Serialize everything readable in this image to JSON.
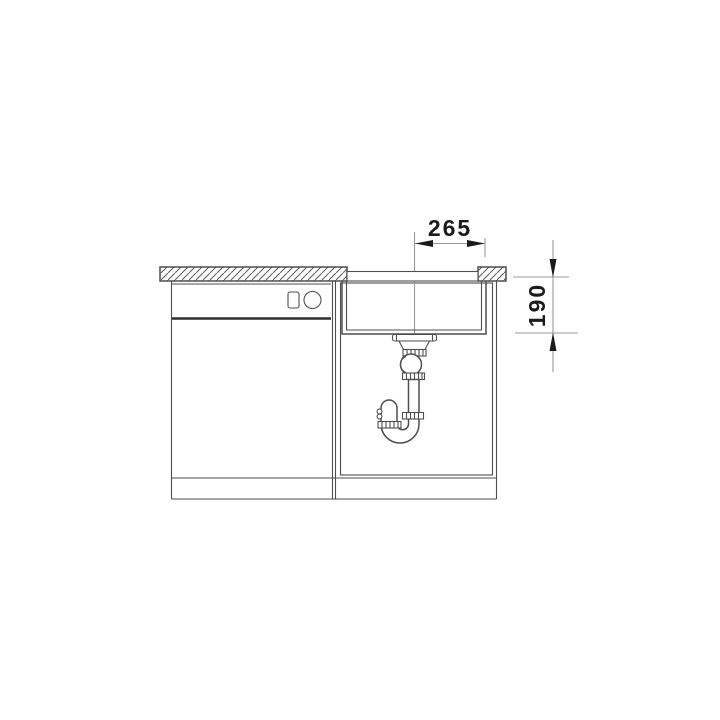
{
  "diagram": {
    "title": "sink-installation-section-drawing",
    "type": "technical line drawing",
    "dimensions": [
      {
        "name": "drain-to-edge-width",
        "value": "265",
        "orientation": "horizontal"
      },
      {
        "name": "bowl-depth",
        "value": "190",
        "orientation": "vertical"
      }
    ],
    "colors": {
      "bg": "#ffffff",
      "line": "#4e4e4e",
      "dim": "#9b9b9b",
      "ink": "#1b1b1b"
    },
    "parts": [
      "countertop-section-hatched",
      "sink-rim",
      "sink-bowl",
      "drain-strainer",
      "siphon-p-trap",
      "adjacent-cabinet",
      "sink-base-cabinet",
      "cabinet-plinth"
    ]
  }
}
